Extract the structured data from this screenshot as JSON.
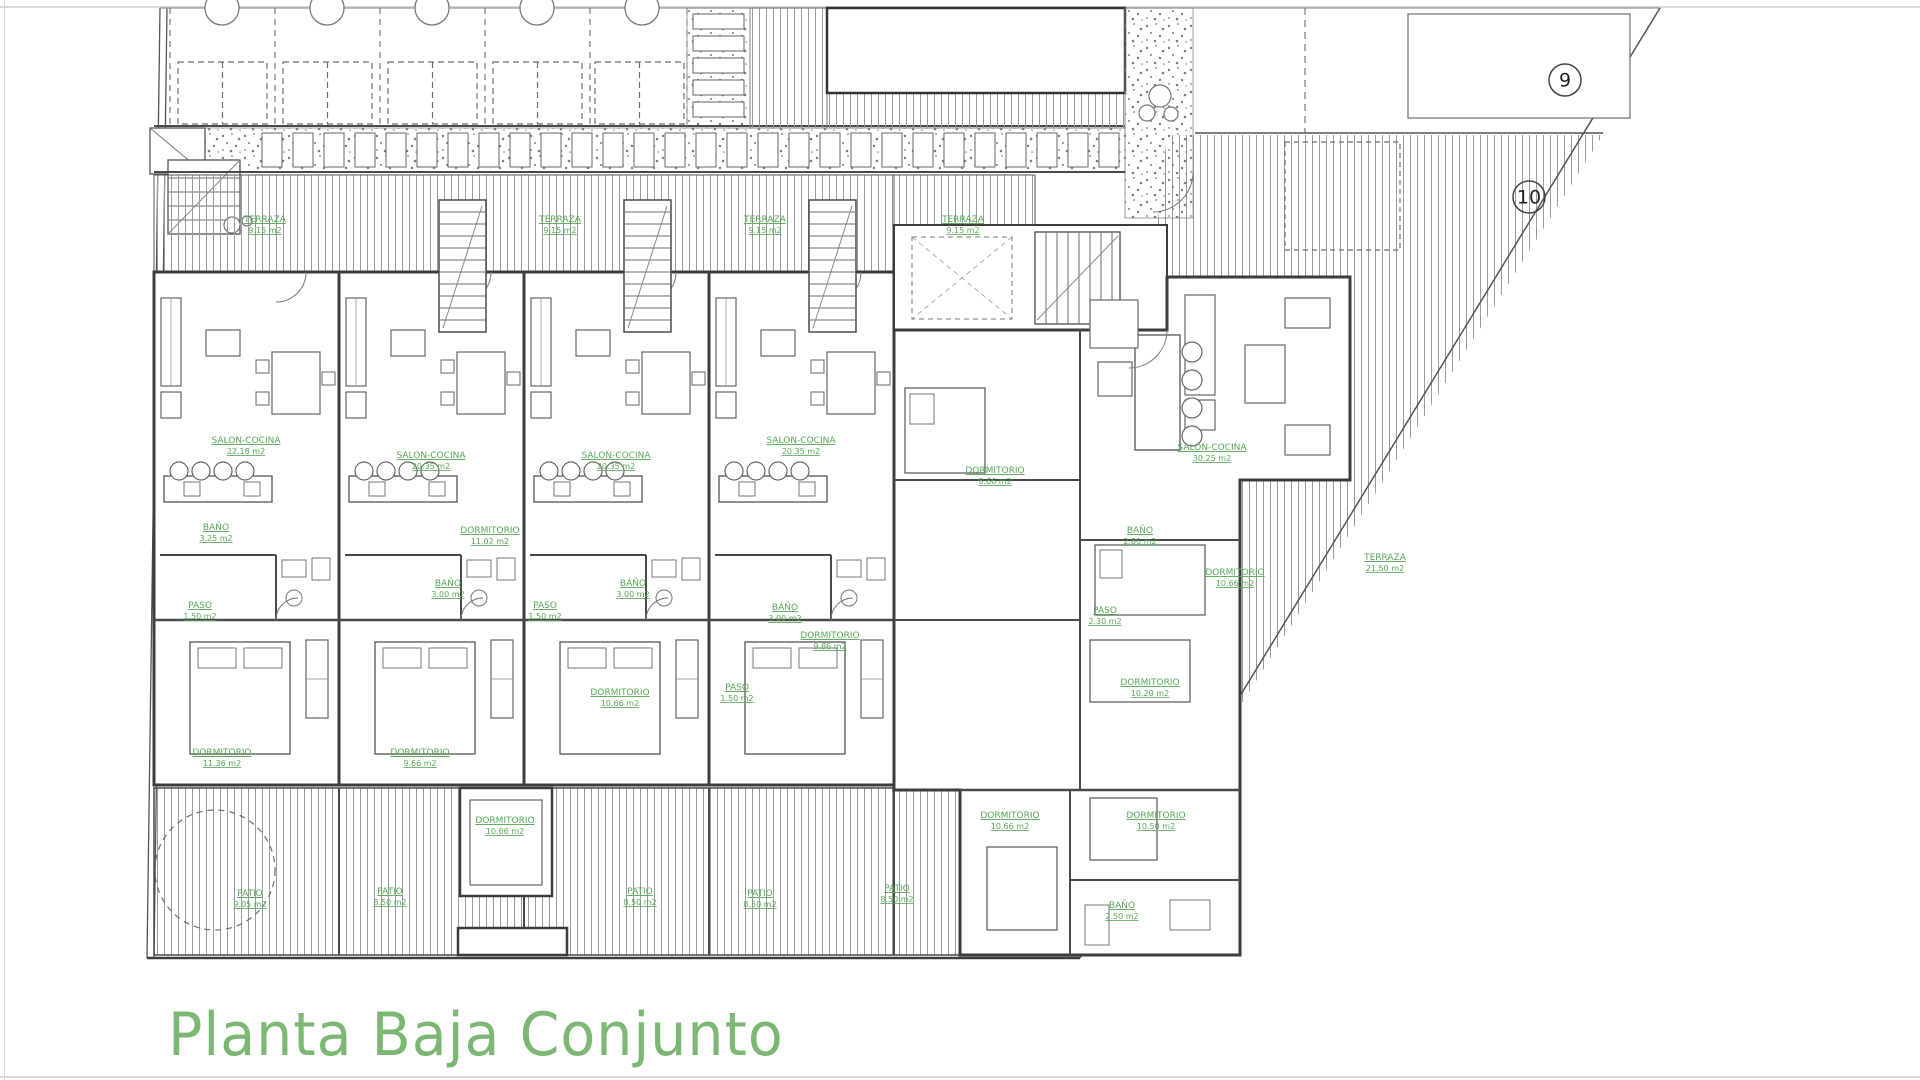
{
  "title": {
    "text": "Planta Baja Conjunto",
    "color": "#7cb874"
  },
  "drawing": {
    "type": "architectural-floor-plan",
    "plan_name": "Planta Baja Conjunto",
    "label_color": "#55a855",
    "wall_color": "#3d3d3d",
    "plot_markers": [
      {
        "label": "9",
        "x": 1565,
        "y": 80
      },
      {
        "label": "10",
        "x": 1529,
        "y": 197
      }
    ],
    "room_labels": [
      {
        "name": "TERRAZA",
        "area": "9.15 m2",
        "x": 265,
        "y": 222
      },
      {
        "name": "TERRAZA",
        "area": "9.15 m2",
        "x": 560,
        "y": 222
      },
      {
        "name": "TERRAZA",
        "area": "9.15 m2",
        "x": 765,
        "y": 222
      },
      {
        "name": "TERRAZA",
        "area": "9.15 m2",
        "x": 963,
        "y": 222
      },
      {
        "name": "SALON-COCINA",
        "area": "22.18 m2",
        "x": 246,
        "y": 443
      },
      {
        "name": "SALON-COCINA",
        "area": "20.35 m2",
        "x": 431,
        "y": 458
      },
      {
        "name": "SALON-COCINA",
        "area": "20.35 m2",
        "x": 616,
        "y": 458
      },
      {
        "name": "SALON-COCINA",
        "area": "20.35 m2",
        "x": 801,
        "y": 443
      },
      {
        "name": "SALON-COCINA",
        "area": "30.25 m2",
        "x": 1212,
        "y": 450
      },
      {
        "name": "BAÑO",
        "area": "3.25 m2",
        "x": 216,
        "y": 530
      },
      {
        "name": "BAÑO",
        "area": "3.00 m2",
        "x": 448,
        "y": 586
      },
      {
        "name": "BAÑO",
        "area": "3.00 m2",
        "x": 633,
        "y": 586
      },
      {
        "name": "BAÑO",
        "area": "3.00 m2",
        "x": 785,
        "y": 610
      },
      {
        "name": "BAÑO",
        "area": "2.80 m2",
        "x": 1140,
        "y": 533
      },
      {
        "name": "PASO",
        "area": "1.50 m2",
        "x": 200,
        "y": 608
      },
      {
        "name": "PASO",
        "area": "1.50 m2",
        "x": 545,
        "y": 608
      },
      {
        "name": "PASO",
        "area": "1.50 m2",
        "x": 737,
        "y": 690
      },
      {
        "name": "PASO",
        "area": "2.30 m2",
        "x": 1105,
        "y": 613
      },
      {
        "name": "DORMITORIO",
        "area": "11.36 m2",
        "x": 222,
        "y": 755
      },
      {
        "name": "DORMITORIO",
        "area": "9.66 m2",
        "x": 420,
        "y": 755
      },
      {
        "name": "DORMITORIO",
        "area": "11.02 m2",
        "x": 490,
        "y": 533
      },
      {
        "name": "DORMITORIO",
        "area": "10.66 m2",
        "x": 620,
        "y": 695
      },
      {
        "name": "DORMITORIO",
        "area": "9.86 m2",
        "x": 830,
        "y": 638
      },
      {
        "name": "DORMITORIO",
        "area": "8.66 m2",
        "x": 995,
        "y": 473
      },
      {
        "name": "DORMITORIO",
        "area": "10.66 m2",
        "x": 1235,
        "y": 575
      },
      {
        "name": "DORMITORIO",
        "area": "10.20 m2",
        "x": 1150,
        "y": 685
      },
      {
        "name": "DORMITORIO",
        "area": "10.66 m2",
        "x": 505,
        "y": 823
      },
      {
        "name": "DORMITORIO",
        "area": "10.66 m2",
        "x": 1010,
        "y": 818
      },
      {
        "name": "DORMITORIO",
        "area": "10.50 m2",
        "x": 1156,
        "y": 818
      },
      {
        "name": "BAÑO",
        "area": "2.50 m2",
        "x": 1122,
        "y": 908
      },
      {
        "name": "PATIO",
        "area": "9.05 m2",
        "x": 250,
        "y": 896
      },
      {
        "name": "PATIO",
        "area": "8.50 m2",
        "x": 390,
        "y": 894
      },
      {
        "name": "PATIO",
        "area": "8.50 m2",
        "x": 640,
        "y": 894
      },
      {
        "name": "PATIO",
        "area": "8.50 m2",
        "x": 760,
        "y": 896
      },
      {
        "name": "PATIO",
        "area": "8.50 m2",
        "x": 897,
        "y": 891
      },
      {
        "name": "TERRAZA",
        "area": "21.50 m2",
        "x": 1385,
        "y": 560
      }
    ]
  }
}
